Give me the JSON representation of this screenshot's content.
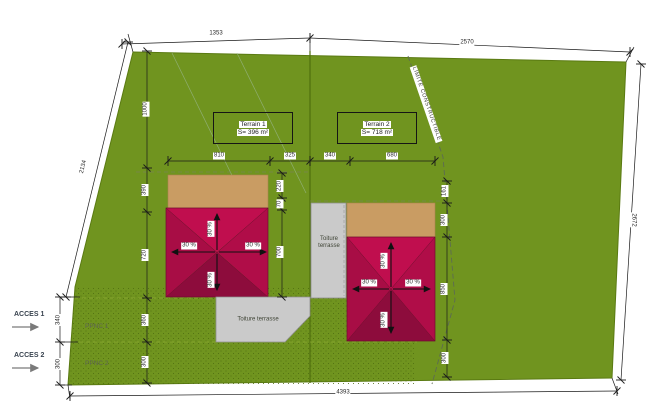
{
  "terrains": {
    "t1": {
      "name": "Terrain 1",
      "area": "S= 396 m²"
    },
    "t2": {
      "name": "Terrain 2",
      "area": "S= 718 m²"
    }
  },
  "labels": {
    "limite": "LIMITE CONSTRUCTIBLE",
    "toiture": "Toiture terrasse",
    "toiture_stack": "Toiture\nterrasse",
    "slope": "30 %",
    "acces1": "ACCES 1",
    "acces2": "ACCES 2",
    "ppnc1": "PPNC 1",
    "ppnc2": "PPNC 2"
  },
  "dims": {
    "top_left": "1353",
    "top_right": "2570",
    "right_side": "2672",
    "bottom": "4393",
    "left_slant": "2134",
    "acces1_h": "340",
    "acces2_h": "300",
    "col_top": "1000",
    "col_390": "390",
    "col_720": "720",
    "col_360": "360",
    "col_300": "300",
    "row_810": "810",
    "row_325": "325",
    "row_340": "340",
    "row_680": "680",
    "b1_top": "220",
    "b1_mid": "70",
    "b1_height": "700",
    "b2_gap": "161",
    "b2_tan": "300",
    "b2_height": "850",
    "b2_bottom": "300"
  },
  "colors": {
    "site_green": "#70941f",
    "stipple_dot": "#4e6c10",
    "roof_bright": "#c00e4e",
    "roof_mid": "#a80d45",
    "roof_dark": "#8d0c3c",
    "tan": "#c99c63",
    "terrace_grey": "#cacaca",
    "dim_line": "#1a1a1a"
  }
}
